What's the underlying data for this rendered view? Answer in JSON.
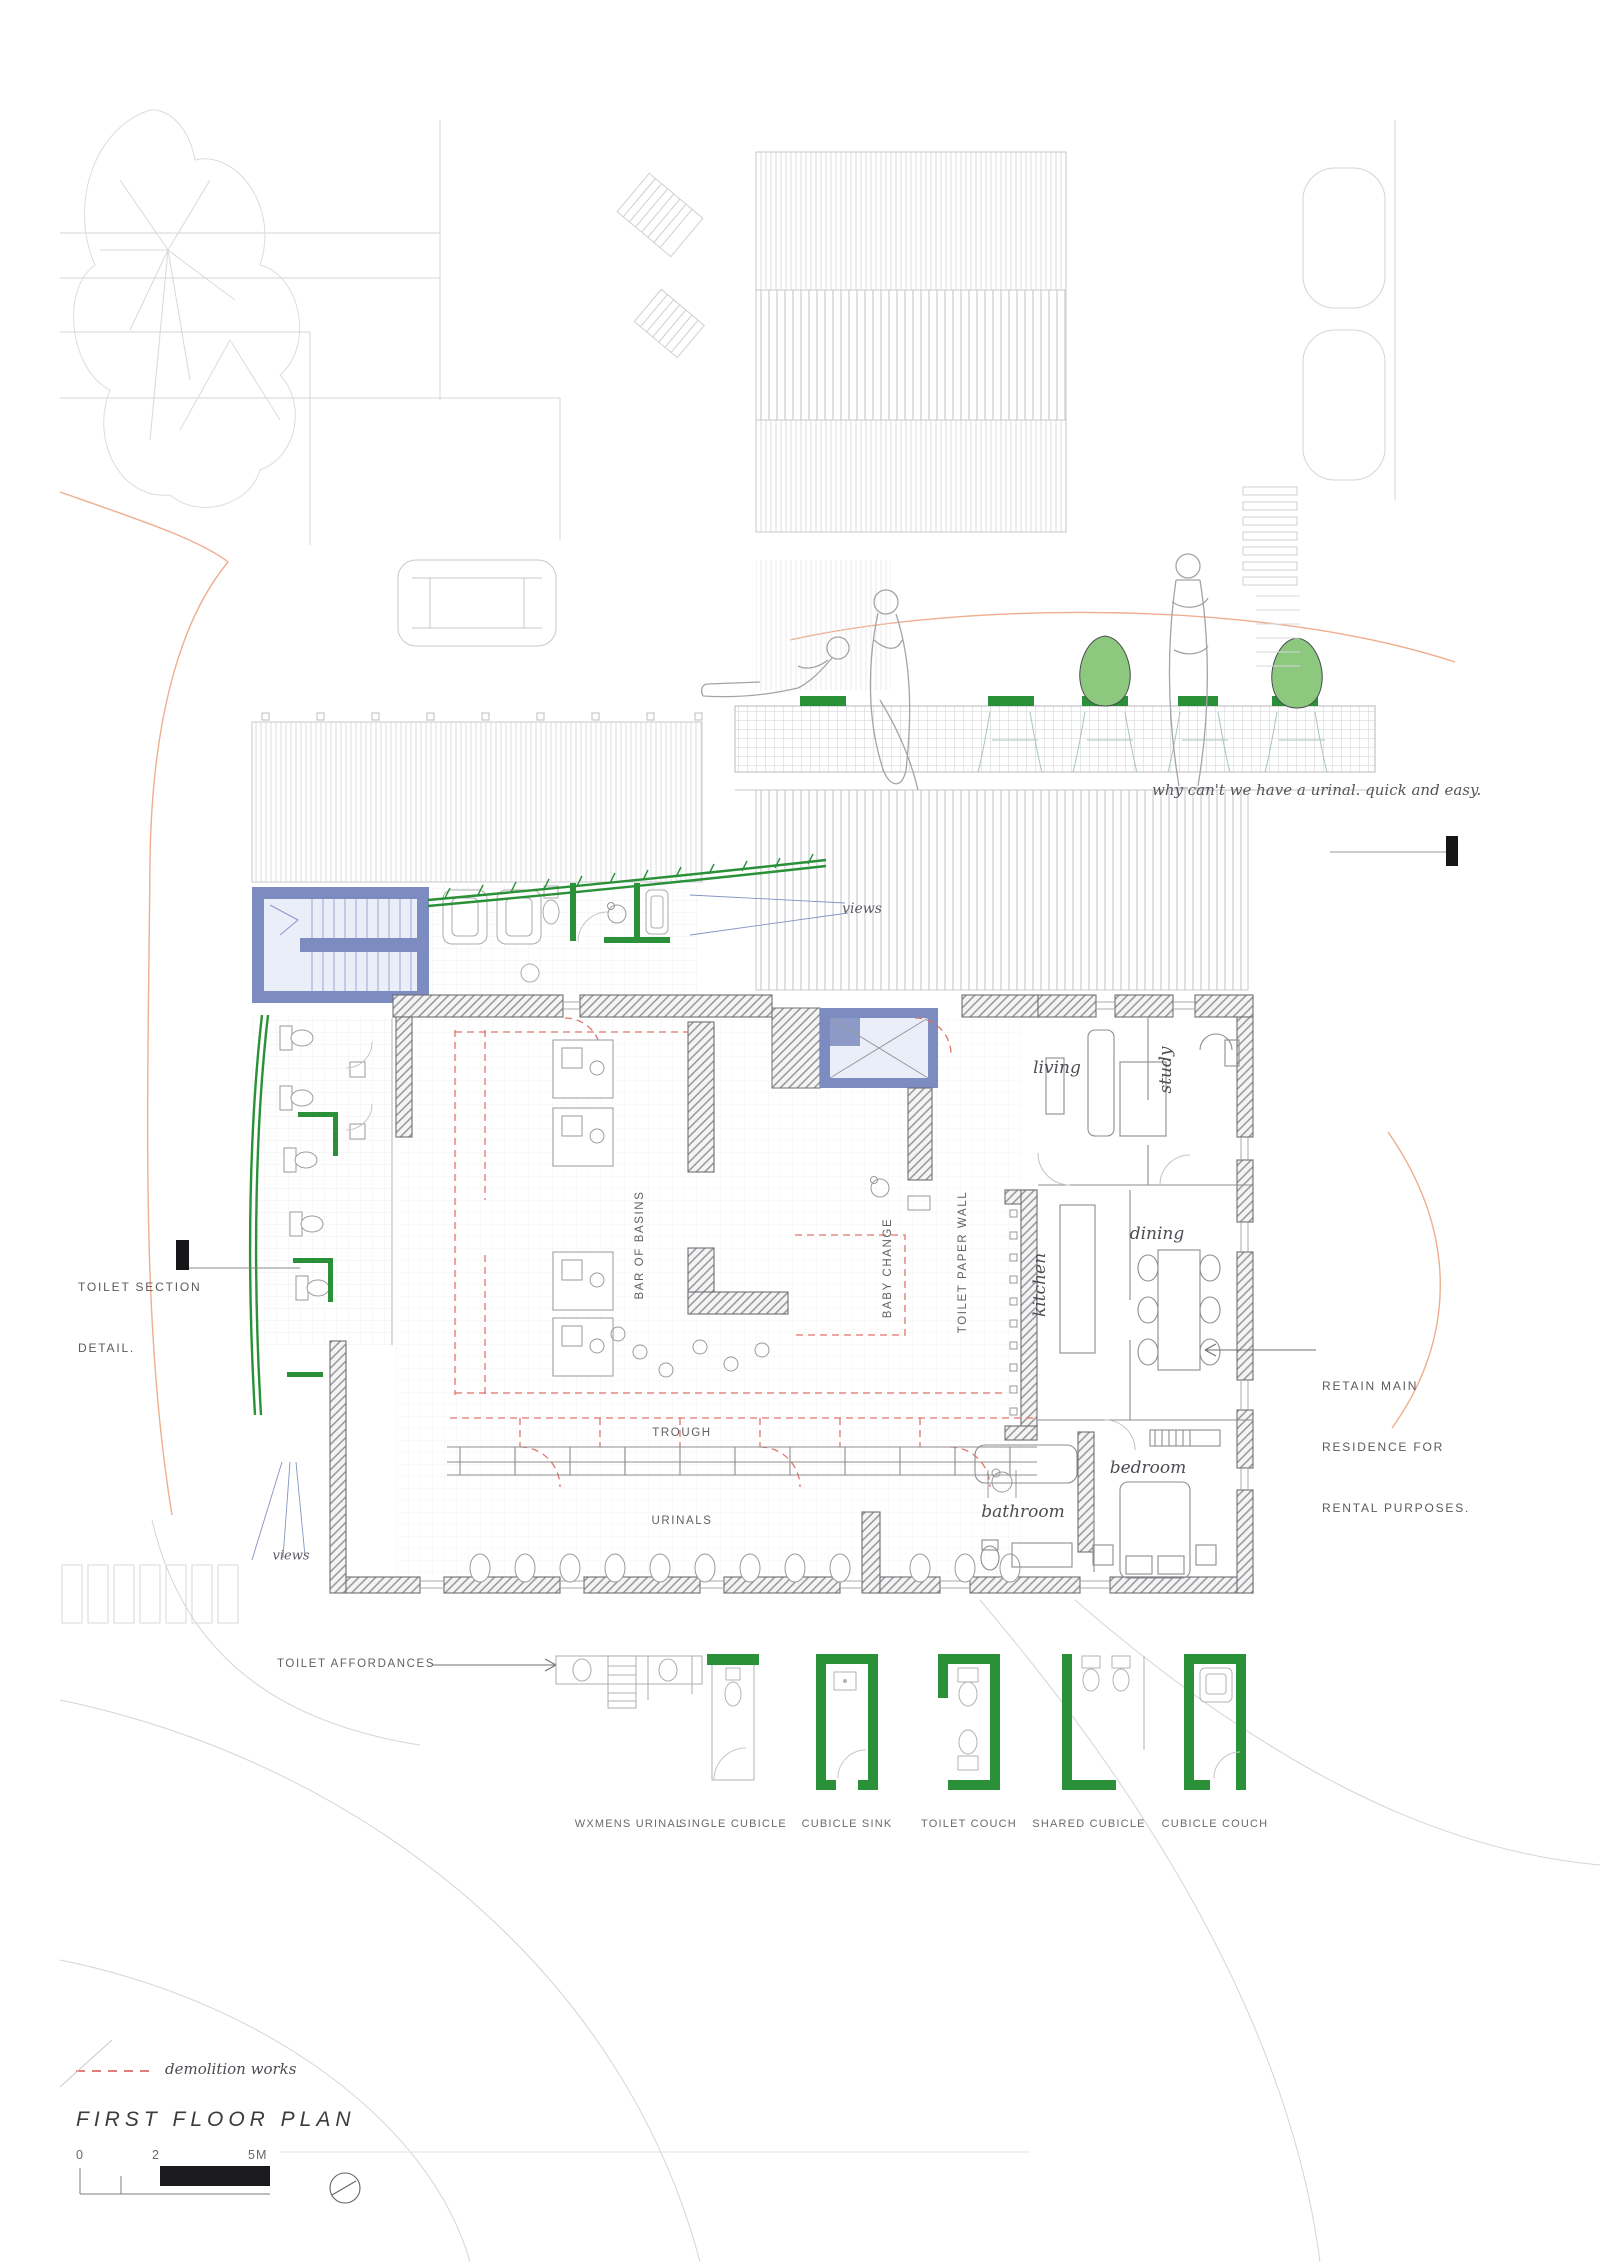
{
  "title": "FIRST FLOOR PLAN",
  "annotations": {
    "urinal_note": "why can't we have a urinal. quick and easy.",
    "views_top": "views",
    "views_bottom": "views",
    "toilet_section_line1": "TOILET SECTION",
    "toilet_section_line2": "DETAIL.",
    "retain_line1": "RETAIN MAIN",
    "retain_line2": "RESIDENCE FOR",
    "retain_line3": "RENTAL PURPOSES.",
    "toilet_affordances": "TOILET AFFORDANCES",
    "demolition_legend": "demolition works"
  },
  "plan_labels": {
    "bar_of_basins": "BAR OF BASINS",
    "baby_change": "BABY CHANGE",
    "toilet_paper_wall": "TOILET PAPER WALL",
    "trough": "TROUGH",
    "urinals": "URINALS"
  },
  "rooms": {
    "living": "living",
    "study": "study",
    "kitchen": "kitchen",
    "dining": "dining",
    "bedroom": "bedroom",
    "bathroom": "bathroom"
  },
  "legend": {
    "items": [
      {
        "label": "WXMENS URINAL"
      },
      {
        "label": "SINGLE CUBICLE"
      },
      {
        "label": "CUBICLE SINK"
      },
      {
        "label": "TOILET COUCH"
      },
      {
        "label": "SHARED CUBICLE"
      },
      {
        "label": "CUBICLE COUCH"
      }
    ]
  },
  "scale_bar": {
    "tick0": "0",
    "tick1": "2",
    "tick2": "5M"
  },
  "colors": {
    "cubicle_green": "#2a9138",
    "tree_green": "#8cc87d",
    "blue_wall": "#7c8bc0",
    "blue_fill": "#e9eef8",
    "demolition_red": "#e0756b",
    "site_orange": "#eeae8f"
  }
}
